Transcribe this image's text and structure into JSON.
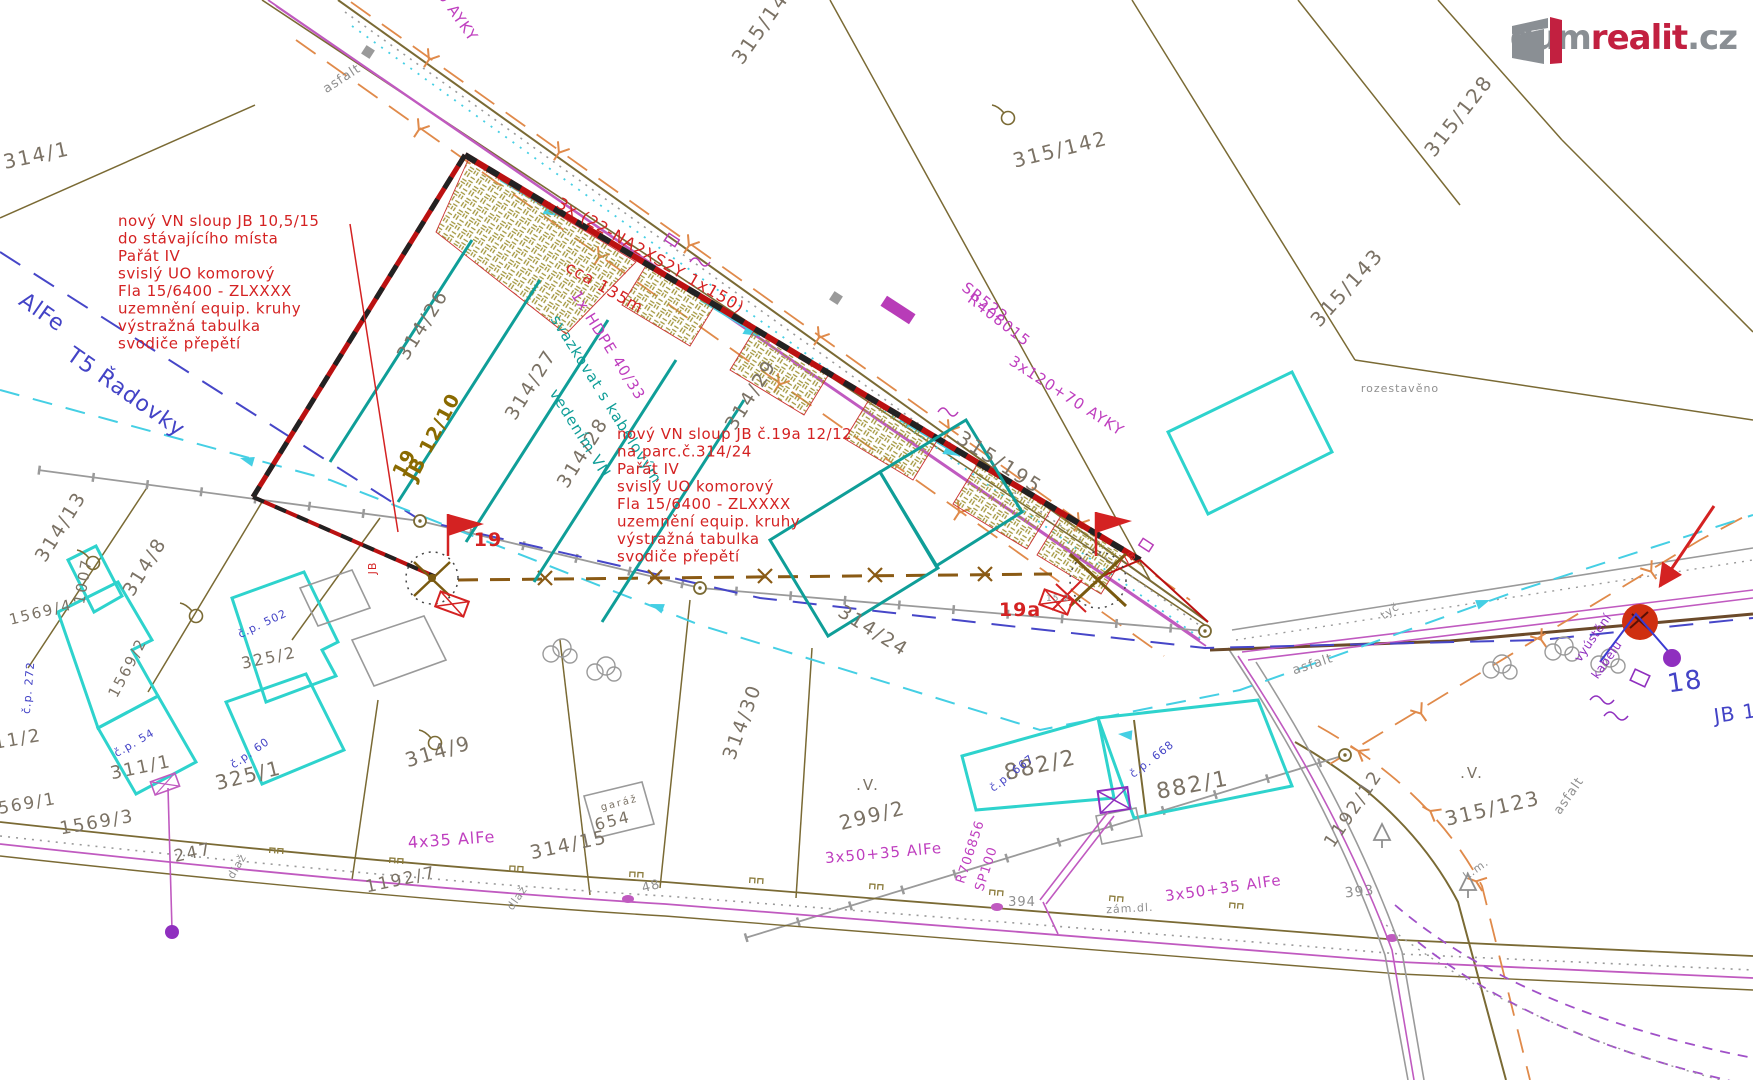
{
  "watermark": {
    "word1": "dum",
    "word2": "realit",
    "word3": ".cz"
  },
  "notes": {
    "pole19": {
      "x": 118,
      "y": 226,
      "lines": [
        "nový VN sloup JB 10,5/15",
        "do stávajícího místa",
        "Pařát IV",
        "svislý UO komorový",
        "Fla 15/6400 - ZLXXXX",
        "uzemnění equip. kruhy",
        "výstražná tabulka",
        "svodiče přepětí"
      ]
    },
    "pole19a": {
      "x": 617,
      "y": 439,
      "lines": [
        "nový VN sloup JB č.19a 12/12",
        "na parc.č.314/24",
        "Pařát IV",
        "svislý UO komorový",
        "Fla 15/6400 - ZLXXXX",
        "uzemnění equip. kruhy",
        "výstražná tabulka",
        "svodiče přepětí"
      ]
    }
  },
  "map": {
    "labels": [
      {
        "t": "314/1",
        "x": 38,
        "y": 162,
        "r": -12,
        "c": "p",
        "s": 20
      },
      {
        "t": "315/141",
        "x": 770,
        "y": 26,
        "r": -55,
        "c": "p",
        "s": 20
      },
      {
        "t": "315/142",
        "x": 1062,
        "y": 156,
        "r": -14,
        "c": "p",
        "s": 20
      },
      {
        "t": "315/128",
        "x": 1464,
        "y": 120,
        "r": -52,
        "c": "p",
        "s": 20
      },
      {
        "t": "315/143",
        "x": 1352,
        "y": 292,
        "r": -48,
        "c": "p",
        "s": 20
      },
      {
        "t": "315/195",
        "x": 996,
        "y": 468,
        "r": 33,
        "c": "p",
        "s": 20
      },
      {
        "t": "314/26",
        "x": 428,
        "y": 328,
        "r": -58,
        "c": "p",
        "s": 19
      },
      {
        "t": "314/27",
        "x": 536,
        "y": 388,
        "r": -58,
        "c": "p",
        "s": 19
      },
      {
        "t": "314/28",
        "x": 588,
        "y": 456,
        "r": -58,
        "c": "p",
        "s": 19
      },
      {
        "t": "314/29",
        "x": 756,
        "y": 398,
        "r": -58,
        "c": "p",
        "s": 19
      },
      {
        "t": "314/24",
        "x": 870,
        "y": 636,
        "r": 32,
        "c": "p",
        "s": 19
      },
      {
        "t": "314/30",
        "x": 748,
        "y": 724,
        "r": -70,
        "c": "p",
        "s": 19
      },
      {
        "t": "314/13",
        "x": 66,
        "y": 530,
        "r": -58,
        "c": "p",
        "s": 19
      },
      {
        "t": "314/8",
        "x": 150,
        "y": 570,
        "r": -58,
        "c": "p",
        "s": 19
      },
      {
        "t": "1007",
        "x": 88,
        "y": 582,
        "r": -80,
        "c": "p",
        "s": 15
      },
      {
        "t": "1569/4",
        "x": 42,
        "y": 617,
        "r": -14,
        "c": "p",
        "s": 15
      },
      {
        "t": "1569/2",
        "x": 132,
        "y": 670,
        "r": -62,
        "c": "p",
        "s": 15
      },
      {
        "t": "325/2",
        "x": 270,
        "y": 663,
        "r": -12,
        "c": "p",
        "s": 16
      },
      {
        "t": "311/2",
        "x": 12,
        "y": 746,
        "r": -10,
        "c": "p",
        "s": 18
      },
      {
        "t": "311/1",
        "x": 142,
        "y": 773,
        "r": -12,
        "c": "p",
        "s": 18
      },
      {
        "t": "325/1",
        "x": 250,
        "y": 782,
        "r": -14,
        "c": "p",
        "s": 20
      },
      {
        "t": "1569/1",
        "x": 22,
        "y": 810,
        "r": -10,
        "c": "p",
        "s": 17
      },
      {
        "t": "1569/3",
        "x": 98,
        "y": 828,
        "r": -10,
        "c": "p",
        "s": 18
      },
      {
        "t": "247",
        "x": 194,
        "y": 858,
        "r": -12,
        "c": "p",
        "s": 17
      },
      {
        "t": "1192/7",
        "x": 402,
        "y": 885,
        "r": -12,
        "c": "p",
        "s": 17
      },
      {
        "t": "654",
        "x": 614,
        "y": 826,
        "r": -14,
        "c": "p",
        "s": 16
      },
      {
        "t": "garáž",
        "x": 620,
        "y": 806,
        "r": -14,
        "c": "p",
        "s": 10
      },
      {
        "t": "314/9",
        "x": 440,
        "y": 758,
        "r": -16,
        "c": "p",
        "s": 20
      },
      {
        "t": "314/15",
        "x": 570,
        "y": 851,
        "r": -12,
        "c": "p",
        "s": 19
      },
      {
        "t": "299/2",
        "x": 874,
        "y": 822,
        "r": -14,
        "c": "p",
        "s": 20
      },
      {
        "t": "882/2",
        "x": 1042,
        "y": 772,
        "r": -13,
        "c": "p",
        "s": 22
      },
      {
        "t": "882/1",
        "x": 1194,
        "y": 792,
        "r": -11,
        "c": "p",
        "s": 22
      },
      {
        "t": "1192/12",
        "x": 1358,
        "y": 812,
        "r": -56,
        "c": "p",
        "s": 18
      },
      {
        "t": "315/123",
        "x": 1494,
        "y": 815,
        "r": -13,
        "c": "p",
        "s": 20
      },
      {
        "t": ".V.",
        "x": 868,
        "y": 790,
        "r": 0,
        "c": "p",
        "s": 15
      },
      {
        "t": ".V.",
        "x": 1472,
        "y": 778,
        "r": 0,
        "c": "p",
        "s": 15
      },
      {
        "t": "393",
        "x": 1360,
        "y": 896,
        "r": -6,
        "c": "g",
        "s": 14
      },
      {
        "t": "394",
        "x": 1022,
        "y": 906,
        "r": 0,
        "c": "g",
        "s": 13
      },
      {
        "t": "48",
        "x": 652,
        "y": 890,
        "r": -14,
        "c": "g",
        "s": 13
      },
      {
        "t": "rozestavěno",
        "x": 1400,
        "y": 392,
        "r": 0,
        "c": "g",
        "s": 11
      },
      {
        "t": "asfalt",
        "x": 344,
        "y": 82,
        "r": -33,
        "c": "g",
        "s": 13
      },
      {
        "t": "asfalt",
        "x": 1314,
        "y": 668,
        "r": -18,
        "c": "g",
        "s": 13
      },
      {
        "t": "asfalt",
        "x": 1572,
        "y": 798,
        "r": -55,
        "c": "g",
        "s": 13
      },
      {
        "t": "dlaž",
        "x": 240,
        "y": 868,
        "r": -60,
        "c": "g",
        "s": 11
      },
      {
        "t": "dlaž",
        "x": 520,
        "y": 900,
        "r": -55,
        "c": "g",
        "s": 11
      },
      {
        "t": "k.m.",
        "x": 1478,
        "y": 872,
        "r": -35,
        "c": "g",
        "s": 11
      },
      {
        "t": "tyč",
        "x": 1392,
        "y": 614,
        "r": -35,
        "c": "g",
        "s": 11
      },
      {
        "t": "15.2",
        "x": 1058,
        "y": 601,
        "r": 0,
        "c": "g",
        "s": 9
      },
      {
        "t": "zám.dl.",
        "x": 1130,
        "y": 912,
        "r": -3,
        "c": "g",
        "s": 11
      },
      {
        "t": "č.p. 502",
        "x": 264,
        "y": 627,
        "r": -25,
        "c": "b",
        "s": 11
      },
      {
        "t": "č.p. 272",
        "x": 32,
        "y": 688,
        "r": -85,
        "c": "b",
        "s": 11
      },
      {
        "t": "č.p. 54",
        "x": 136,
        "y": 746,
        "r": -30,
        "c": "b",
        "s": 11
      },
      {
        "t": "č.p. 60",
        "x": 252,
        "y": 756,
        "r": -35,
        "c": "b",
        "s": 11
      },
      {
        "t": "č.p. 667",
        "x": 1014,
        "y": 776,
        "r": -38,
        "c": "b",
        "s": 11
      },
      {
        "t": "č.p. 668",
        "x": 1154,
        "y": 762,
        "r": -38,
        "c": "b",
        "s": 11
      },
      {
        "t": "AlFe",
        "x": 38,
        "y": 318,
        "r": 35,
        "c": "b",
        "s": 22
      },
      {
        "t": "T5 Řadovky",
        "x": 122,
        "y": 398,
        "r": 35,
        "c": "b",
        "s": 22
      },
      {
        "t": "18",
        "x": 1686,
        "y": 690,
        "r": -8,
        "c": "b",
        "s": 26
      },
      {
        "t": "JB 1",
        "x": 1736,
        "y": 720,
        "r": -8,
        "c": "b",
        "s": 20
      },
      {
        "t": "1x HDPE 40/33",
        "x": 604,
        "y": 348,
        "r": 58,
        "c": "m",
        "s": 15
      },
      {
        "t": "SR522",
        "x": 982,
        "y": 306,
        "r": 38,
        "c": "m",
        "s": 15
      },
      {
        "t": "R408015",
        "x": 996,
        "y": 324,
        "r": 38,
        "c": "m",
        "s": 15
      },
      {
        "t": "3x120+70 AYKY",
        "x": 1064,
        "y": 400,
        "r": 33,
        "c": "m",
        "s": 15
      },
      {
        "t": "3x120+70 AYKY",
        "x": 432,
        "y": -12,
        "r": 55,
        "c": "m",
        "s": 15
      },
      {
        "t": "4x35 AlFe",
        "x": 452,
        "y": 845,
        "r": -4,
        "c": "m",
        "s": 16
      },
      {
        "t": "3x50+35 AlFe",
        "x": 884,
        "y": 858,
        "r": -5,
        "c": "m",
        "s": 15
      },
      {
        "t": "3x50+35 AlFe",
        "x": 1224,
        "y": 893,
        "r": -8,
        "c": "m",
        "s": 15
      },
      {
        "t": "R706856",
        "x": 974,
        "y": 853,
        "r": -72,
        "c": "m",
        "s": 13
      },
      {
        "t": "SP100",
        "x": 990,
        "y": 870,
        "r": -72,
        "c": "m",
        "s": 13
      },
      {
        "t": "vyústění",
        "x": 1596,
        "y": 640,
        "r": -55,
        "c": "v",
        "s": 12
      },
      {
        "t": "kabelu",
        "x": 1610,
        "y": 662,
        "r": -55,
        "c": "v",
        "s": 12
      },
      {
        "t": "svazkovat s kabelovým",
        "x": 602,
        "y": 402,
        "r": 58,
        "c": "t",
        "s": 15
      },
      {
        "t": "vedením  VN",
        "x": 576,
        "y": 436,
        "r": 58,
        "c": "t",
        "s": 15
      },
      {
        "t": "3x (22-NA2XS2Y 1x150)",
        "x": 648,
        "y": 260,
        "r": 30,
        "c": "r",
        "s": 16
      },
      {
        "t": "cca 135m",
        "x": 602,
        "y": 292,
        "r": 30,
        "c": "r",
        "s": 16
      },
      {
        "t": "19",
        "x": 488,
        "y": 546,
        "r": 0,
        "c": "r",
        "s": 19,
        "b": 1
      },
      {
        "t": "19a",
        "x": 1020,
        "y": 616,
        "r": 0,
        "c": "r",
        "s": 19,
        "b": 1
      },
      {
        "t": "JB",
        "x": 376,
        "y": 568,
        "r": -90,
        "c": "r",
        "s": 11
      },
      {
        "t": "JB",
        "x": 1132,
        "y": 560,
        "r": -30,
        "c": "r",
        "s": 11
      },
      {
        "t": "19",
        "x": 410,
        "y": 466,
        "r": -62,
        "c": "o",
        "s": 19
      },
      {
        "t": "JB 12/10",
        "x": 438,
        "y": 440,
        "r": -62,
        "c": "o",
        "s": 19
      }
    ]
  }
}
